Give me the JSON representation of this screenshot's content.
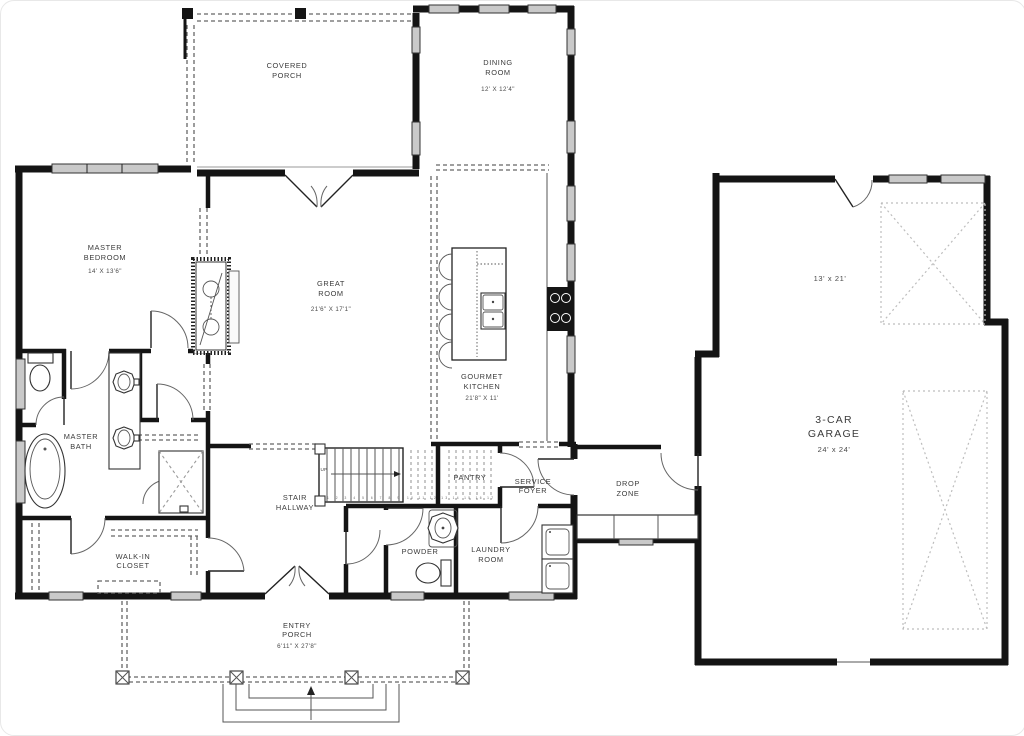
{
  "plan": {
    "rooms": {
      "covered_porch": {
        "l1": "COVERED",
        "l2": "PORCH"
      },
      "dining_room": {
        "l1": "DINING",
        "l2": "ROOM",
        "dim": "12' X 12'4\""
      },
      "master_bedroom": {
        "l1": "MASTER",
        "l2": "BEDROOM",
        "dim": "14' X 13'6\""
      },
      "great_room": {
        "l1": "GREAT",
        "l2": "ROOM",
        "dim": "21'6\" X 17'1\""
      },
      "gourmet_kitchen": {
        "l1": "GOURMET",
        "l2": "KITCHEN",
        "dim": "21'8\" X 11'"
      },
      "master_bath": {
        "l1": "MASTER",
        "l2": "BATH"
      },
      "walk_in_closet": {
        "l1": "WALK-IN",
        "l2": "CLOSET"
      },
      "stair_hallway": {
        "l1": "STAIR",
        "l2": "HALLWAY"
      },
      "pantry": {
        "l1": "PANTRY"
      },
      "service_foyer": {
        "l1": "SERVICE",
        "l2": "FOYER"
      },
      "powder": {
        "l1": "POWDER"
      },
      "laundry_room": {
        "l1": "LAUNDRY",
        "l2": "ROOM"
      },
      "drop_zone": {
        "l1": "DROP",
        "l2": "ZONE"
      },
      "entry_porch": {
        "l1": "ENTRY",
        "l2": "PORCH",
        "dim": "6'11\" X 27'8\""
      },
      "garage": {
        "l1": "3-CAR",
        "l2": "GARAGE",
        "dim": "24' x 24'",
        "bay_dim": "13' x 21'"
      }
    },
    "stairs": {
      "up": "UP",
      "run1": "1 2 3 4 5 6 7 8 9",
      "run2": "10 11 12 13 14 15 16 17"
    },
    "colors": {
      "wall": "#141414",
      "window": "#c9c9c9",
      "dashed": "#666666",
      "carspace": "#bdbdbd",
      "label": "#3b3b3b",
      "background": "#ffffff"
    }
  }
}
